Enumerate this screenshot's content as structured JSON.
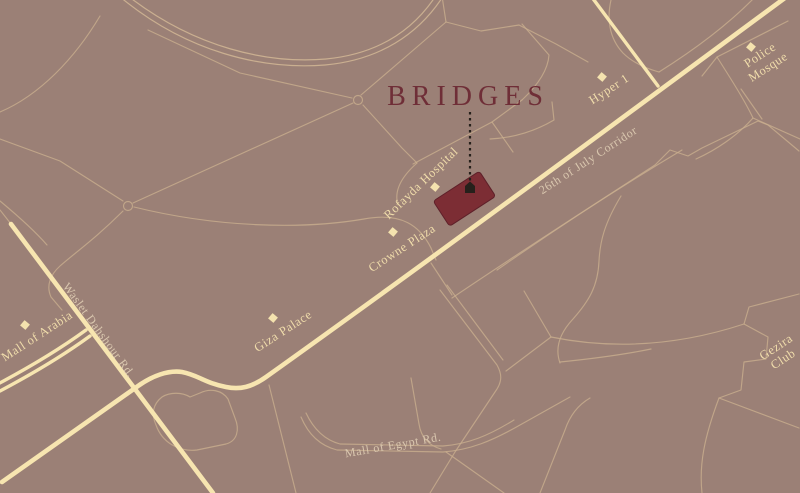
{
  "map": {
    "project_label": "BRIDGES",
    "landmarks": [
      {
        "id": "rofayda-hospital",
        "name": "Rofayda Hospital"
      },
      {
        "id": "crowne-plaza",
        "name": "Crowne Plaza"
      },
      {
        "id": "hyper-1",
        "name": "Hyper 1"
      },
      {
        "id": "police-mosque",
        "name": "Police Mosque",
        "line1": "Police",
        "line2": "Mosque"
      },
      {
        "id": "gezira-club",
        "name": "Gezira Club",
        "line1": "Gezira",
        "line2": "Club"
      },
      {
        "id": "mall-of-arabia",
        "name": "Mall of Arabia"
      },
      {
        "id": "giza-palace",
        "name": "Giza Palace"
      }
    ],
    "roads": [
      {
        "id": "26th-of-july-corridor",
        "name": "26th of July Corridor"
      },
      {
        "id": "waslet-dahshour-rd",
        "name": "Waslet Dahshour Rd."
      },
      {
        "id": "mall-of-egypt-rd",
        "name": "Mall of Egypt Rd."
      }
    ],
    "colors": {
      "background": "#9b8076",
      "thin_road": "#c9ae8f",
      "main_road": "#f7e5b0",
      "site_fill": "#7c2d34",
      "project_text": "#6f2e37",
      "landmark_text": "#f0dcab",
      "road_text": "#dac7af",
      "connector": "#26201b"
    }
  }
}
